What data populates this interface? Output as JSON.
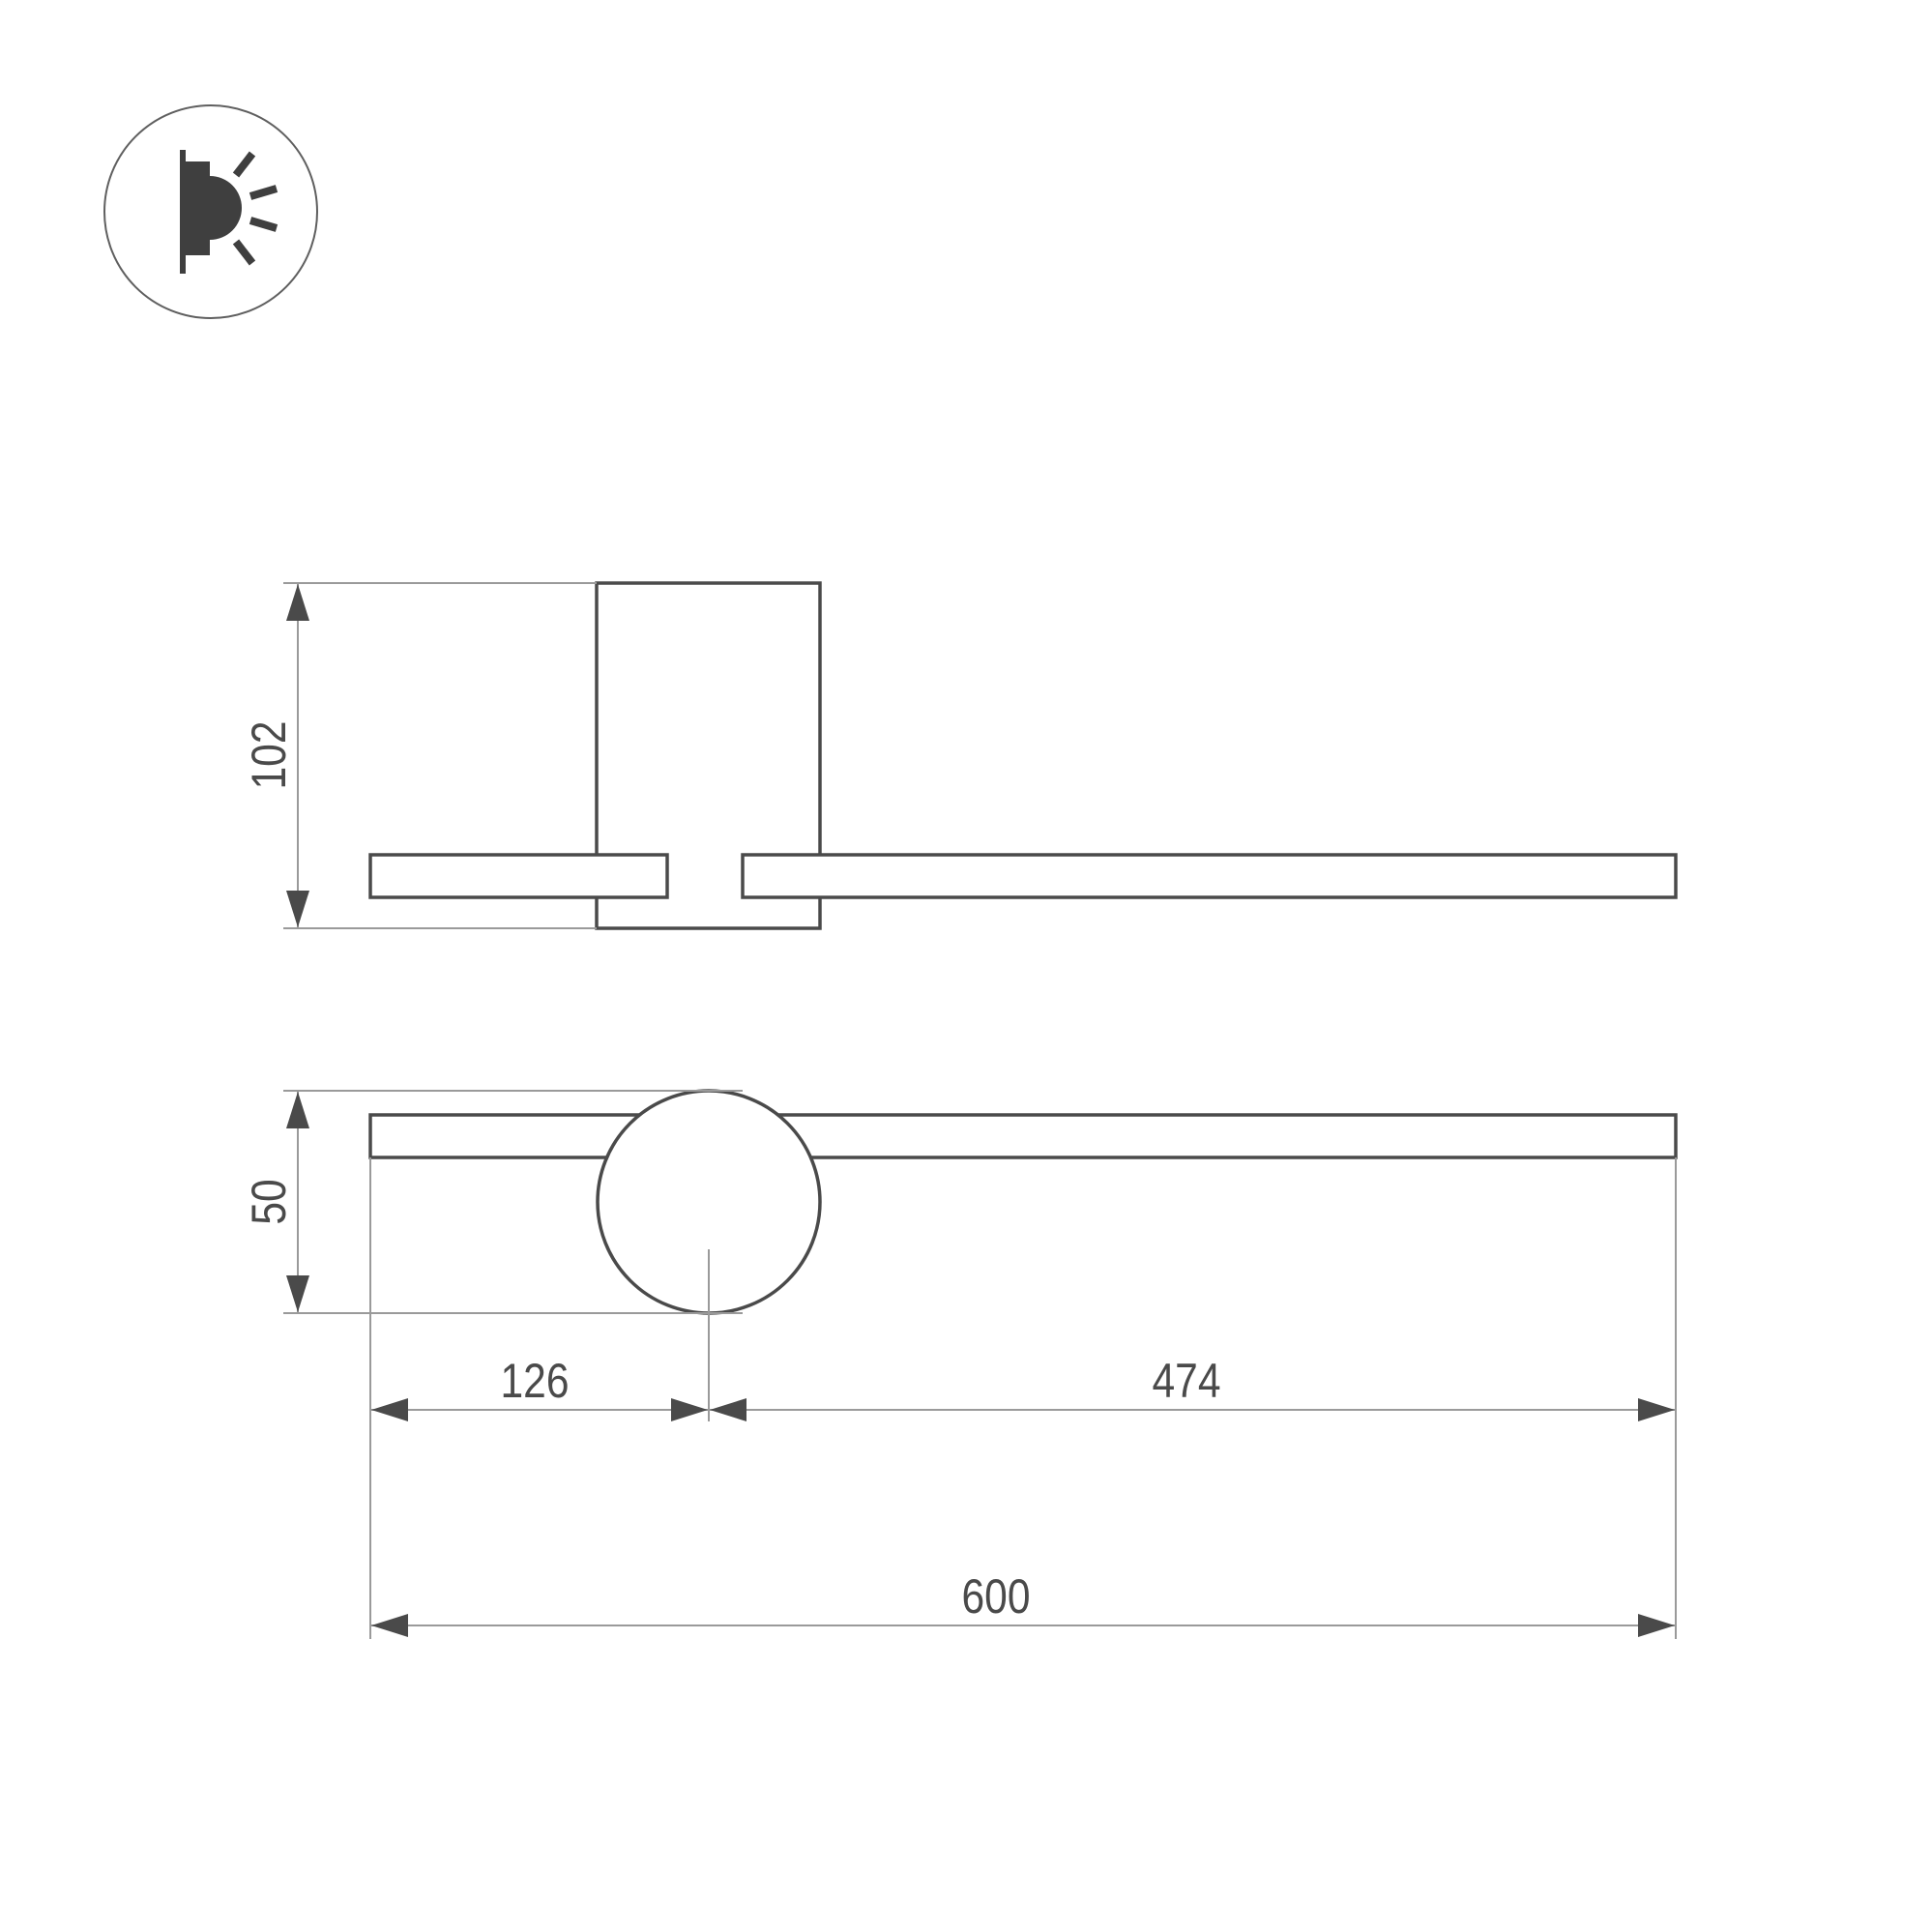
{
  "page": {
    "background_color": "#ffffff",
    "description_labels": []
  },
  "icon": {
    "name": "wall-lamp-glow-icon",
    "circle_stroke_color": "#5f5f5f",
    "glyph_fill_color": "#3f3f3f"
  },
  "drawing": {
    "line_color_dark": "#4a4a4a",
    "line_color_light": "#9a9a9a",
    "text_color": "#4a4a4a",
    "dimensions": {
      "height": "102",
      "plate_diameter": "50",
      "offset_left": "126",
      "offset_right": "474",
      "total_length": "600"
    }
  }
}
